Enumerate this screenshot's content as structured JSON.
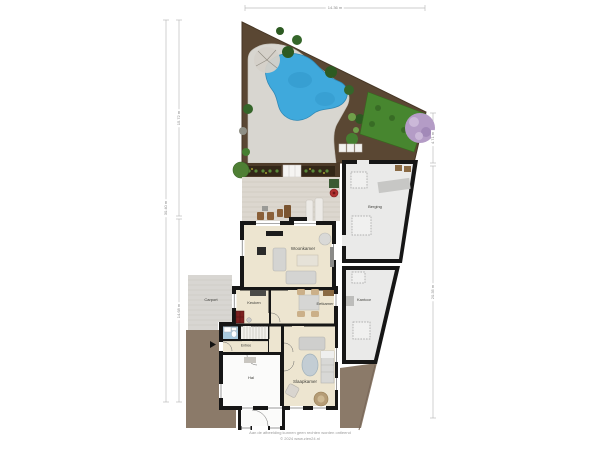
{
  "plan": {
    "type": "floor-plan-with-garden",
    "rooms": {
      "woonkamer": "Woonkamer",
      "eetkamer": "Eetkamer",
      "keuken": "Keuken",
      "slaapkamer": "Slaapkamer",
      "hal": "Hal",
      "entree": "Entree",
      "carport": "Carport",
      "berging": "Berging",
      "kantoor": "Kantoor"
    },
    "dimensions": {
      "top": "14.36 m",
      "left_outer": "30.40 m",
      "left_inner_top": "15.72 m",
      "left_inner_bottom": "14.68 m",
      "right_top": "4.71 m",
      "right_bottom": "20.35 m"
    },
    "footer": {
      "line1": "Aan de afbeelding kunnen geen rechten worden ontleend",
      "line2": "© 2024 www.zien24.nl"
    },
    "colors": {
      "soil": "#5a4733",
      "gravel": "#d8d6d0",
      "pool": "#3fa9dc",
      "hedge": "#47862f",
      "deck": "#dcd7cf",
      "room_beige": "#ede5d0",
      "storage_gray": "#eaeae9",
      "wall": "#161616",
      "drive_brown": "#8b7a69",
      "carport_gray": "#d8d6d2",
      "wc_blue": "#a9cade",
      "purple_tree": "#b49cc6"
    }
  }
}
